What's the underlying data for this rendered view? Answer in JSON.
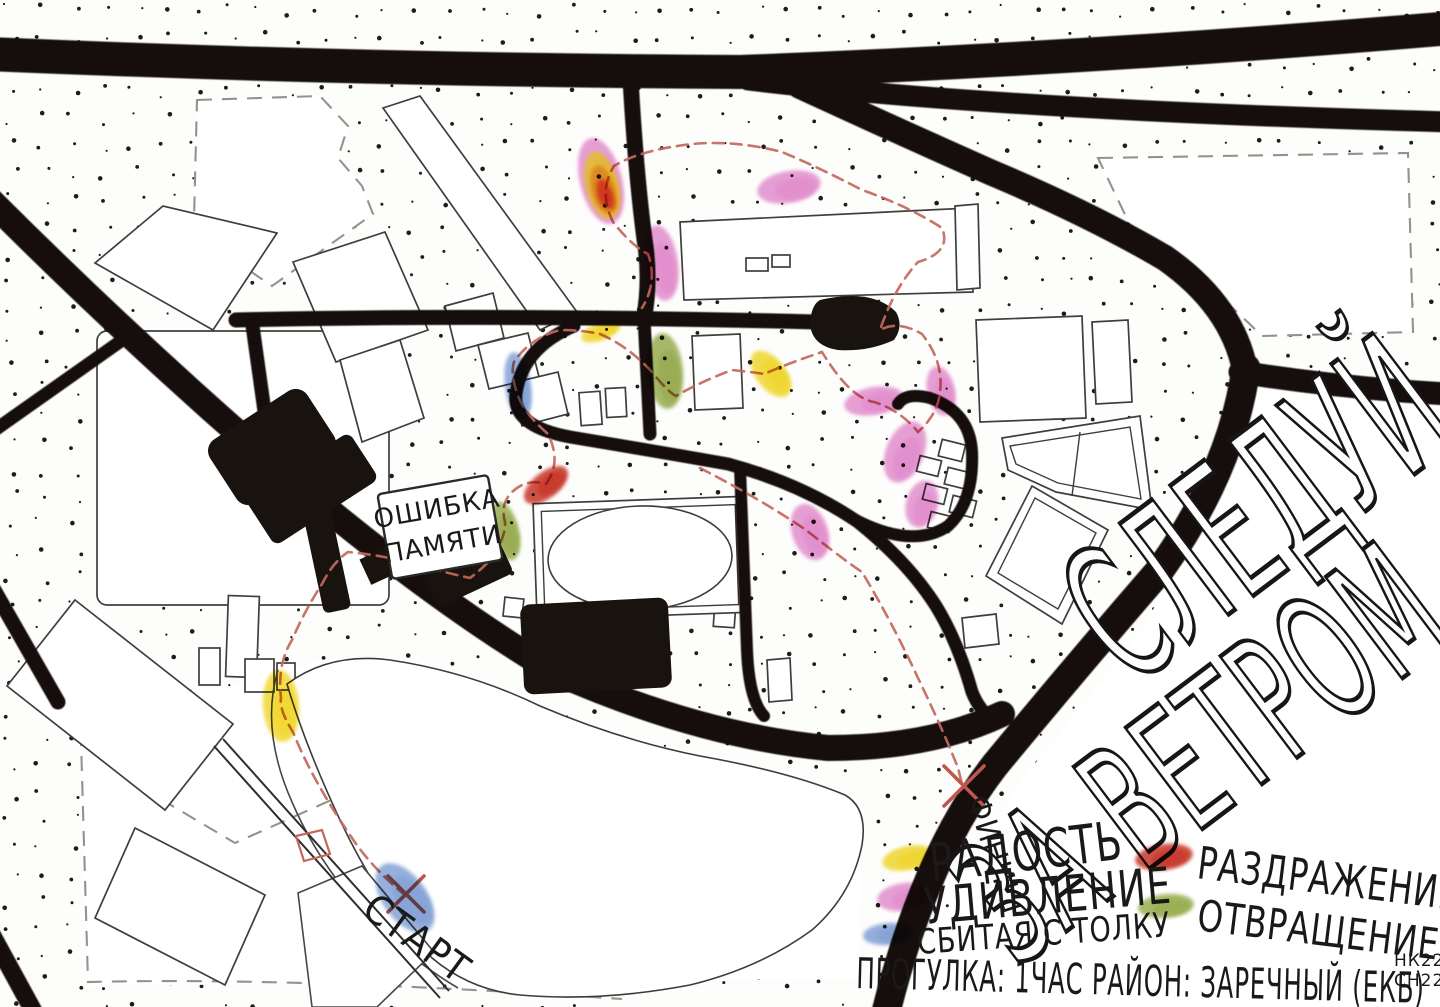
{
  "title": "Психогеографическая карта прогулки",
  "labels": {
    "start": "СТАРТ",
    "finish": "ФИНИШ",
    "note": [
      "ОШИБКА",
      "ПАМЯТИ"
    ],
    "headline": [
      "СЛЕДУЙ",
      "ЗА ВЕТРОМ"
    ]
  },
  "legend": {
    "items": [
      {
        "name": "joy",
        "label": "РАДОСТЬ",
        "color": "#f0d522"
      },
      {
        "name": "surprise",
        "label": "УДИВЛЕНИЕ",
        "color": "#e287cc"
      },
      {
        "name": "confused",
        "label": "СБИТАЯ С ТОЛКУ",
        "color": "#7b9cd4"
      },
      {
        "name": "irritation",
        "label": "РАЗДРАЖЕНИЕ",
        "color": "#c52a1c"
      },
      {
        "name": "disgust",
        "label": "ОТВРАЩЕНИЕ",
        "color": "#92a844"
      }
    ],
    "footer": "ПРОГУЛКА: 1ЧАС  РАЙОН: ЗАРЕЧНЫЙ (ЕКБ)",
    "signature": [
      "НК22",
      "СН22"
    ]
  },
  "map": {
    "route_color": "#c2685c",
    "emotion_marks": [
      {
        "emotion": "irritation",
        "x": 601,
        "y": 181,
        "w": 42,
        "h": 88,
        "rot": -14,
        "colors": [
          "#e287cc",
          "#e5c31f",
          "#e07f1e",
          "#cf2b1d"
        ]
      },
      {
        "emotion": "surprise",
        "x": 789,
        "y": 187,
        "w": 64,
        "h": 32,
        "rot": -10
      },
      {
        "emotion": "surprise",
        "x": 661,
        "y": 263,
        "w": 34,
        "h": 76,
        "rot": -8
      },
      {
        "emotion": "joy",
        "x": 601,
        "y": 331,
        "w": 42,
        "h": 18,
        "rot": -22
      },
      {
        "emotion": "confused",
        "x": 518,
        "y": 386,
        "w": 26,
        "h": 68,
        "rot": -8
      },
      {
        "emotion": "disgust",
        "x": 665,
        "y": 371,
        "w": 36,
        "h": 76,
        "rot": -5
      },
      {
        "emotion": "joy",
        "x": 771,
        "y": 374,
        "w": 30,
        "h": 54,
        "rot": -38
      },
      {
        "emotion": "surprise",
        "x": 874,
        "y": 401,
        "w": 60,
        "h": 28,
        "rot": -10
      },
      {
        "emotion": "surprise",
        "x": 941,
        "y": 391,
        "w": 28,
        "h": 50,
        "rot": -12
      },
      {
        "emotion": "surprise",
        "x": 905,
        "y": 452,
        "w": 38,
        "h": 64,
        "rot": 22
      },
      {
        "emotion": "surprise",
        "x": 922,
        "y": 504,
        "w": 32,
        "h": 48,
        "rot": 15
      },
      {
        "emotion": "irritation",
        "x": 546,
        "y": 485,
        "w": 52,
        "h": 26,
        "rot": -38
      },
      {
        "emotion": "disgust",
        "x": 505,
        "y": 531,
        "w": 28,
        "h": 60,
        "rot": -14
      },
      {
        "emotion": "surprise",
        "x": 810,
        "y": 532,
        "w": 36,
        "h": 58,
        "rot": -18
      },
      {
        "emotion": "joy",
        "x": 281,
        "y": 706,
        "w": 36,
        "h": 72,
        "rot": -4
      },
      {
        "emotion": "confused",
        "x": 405,
        "y": 898,
        "w": 44,
        "h": 80,
        "rot": -36
      }
    ]
  }
}
